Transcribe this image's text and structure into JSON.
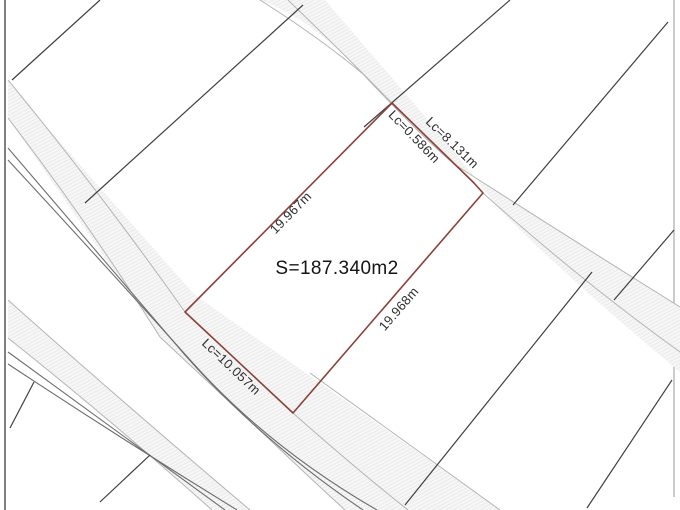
{
  "drawing": {
    "type": "cadastral-parcel-plan",
    "parcel": {
      "area_label": "S=187.340m2",
      "dim_nw_edge": "19.967m",
      "dim_se_edge": "19.968m",
      "dim_sw_frontage": "Lc=10.057m",
      "dim_ne_frontage_long": "Lc=8.131m",
      "dim_ne_frontage_short": "Lc=0.586m"
    },
    "colors": {
      "parcel_boundary": "#8a4238",
      "neighbor_lines": "#3f3f3f",
      "road_edges": "#b5b5b5",
      "road_double_lines": "#6e6e6e",
      "road_hatch": "#e0e0e0",
      "hatch_background": "#f6f6f6",
      "text": "#2e2e2e",
      "background": "#ffffff"
    }
  }
}
